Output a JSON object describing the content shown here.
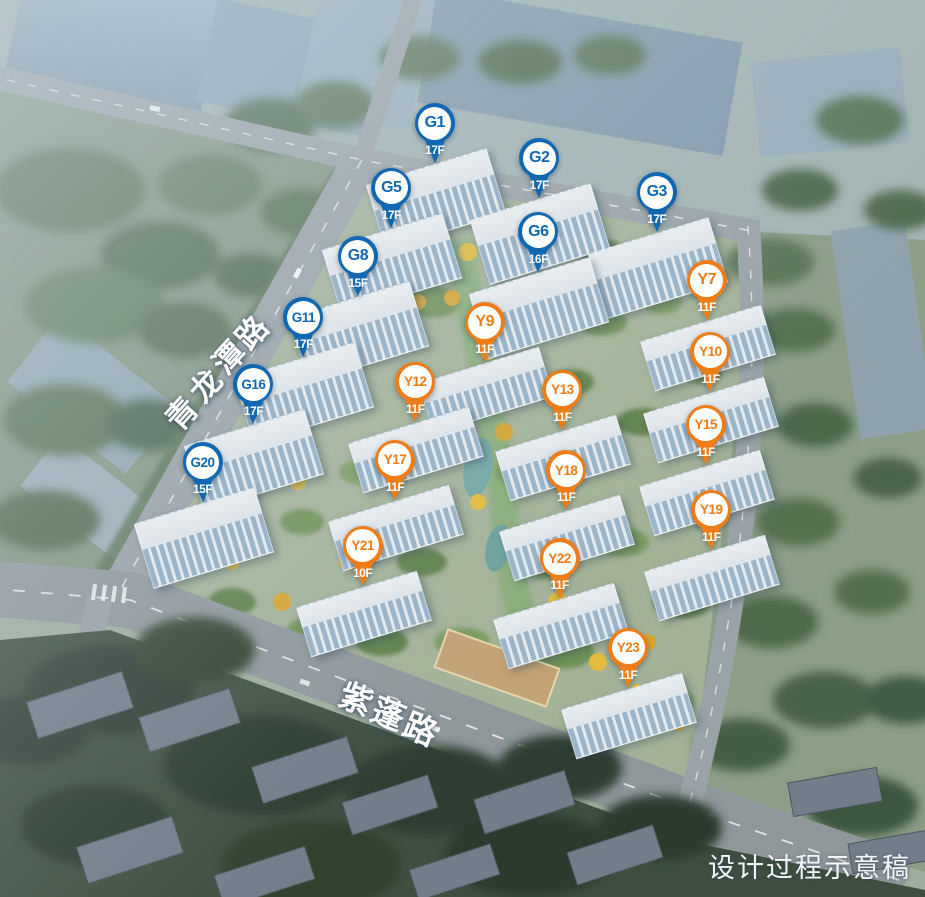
{
  "watermark": "设计过程示意稿",
  "roads": {
    "left_road": "青龙潭路",
    "bottom_road": "紫蓬路"
  },
  "pin_colors": {
    "G": "#1067b2",
    "Y": "#ee7d17"
  },
  "markers": [
    {
      "id": "G1",
      "floors": "17F",
      "type": "G",
      "x": 47.0,
      "y": 18.2
    },
    {
      "id": "G2",
      "floors": "17F",
      "type": "G",
      "x": 58.3,
      "y": 22.1
    },
    {
      "id": "G3",
      "floors": "17F",
      "type": "G",
      "x": 71.0,
      "y": 25.9
    },
    {
      "id": "G5",
      "floors": "17F",
      "type": "G",
      "x": 42.3,
      "y": 25.4
    },
    {
      "id": "G6",
      "floors": "16F",
      "type": "G",
      "x": 58.2,
      "y": 30.3
    },
    {
      "id": "G8",
      "floors": "15F",
      "type": "G",
      "x": 38.7,
      "y": 33.0
    },
    {
      "id": "G11",
      "floors": "17F",
      "type": "G",
      "x": 32.8,
      "y": 39.8
    },
    {
      "id": "G16",
      "floors": "17F",
      "type": "G",
      "x": 27.4,
      "y": 47.3
    },
    {
      "id": "G20",
      "floors": "15F",
      "type": "G",
      "x": 21.9,
      "y": 56.0
    },
    {
      "id": "Y7",
      "floors": "11F",
      "type": "Y",
      "x": 76.4,
      "y": 35.7
    },
    {
      "id": "Y9",
      "floors": "11F",
      "type": "Y",
      "x": 52.4,
      "y": 40.4
    },
    {
      "id": "Y10",
      "floors": "11F",
      "type": "Y",
      "x": 76.8,
      "y": 43.7
    },
    {
      "id": "Y12",
      "floors": "11F",
      "type": "Y",
      "x": 44.9,
      "y": 47.0
    },
    {
      "id": "Y13",
      "floors": "11F",
      "type": "Y",
      "x": 60.8,
      "y": 47.9
    },
    {
      "id": "Y15",
      "floors": "11F",
      "type": "Y",
      "x": 76.3,
      "y": 51.8
    },
    {
      "id": "Y17",
      "floors": "11F",
      "type": "Y",
      "x": 42.7,
      "y": 55.7
    },
    {
      "id": "Y18",
      "floors": "11F",
      "type": "Y",
      "x": 61.2,
      "y": 56.9
    },
    {
      "id": "Y19",
      "floors": "11F",
      "type": "Y",
      "x": 76.9,
      "y": 61.3
    },
    {
      "id": "Y21",
      "floors": "10F",
      "type": "Y",
      "x": 39.2,
      "y": 65.3
    },
    {
      "id": "Y22",
      "floors": "11F",
      "type": "Y",
      "x": 60.5,
      "y": 66.7
    },
    {
      "id": "Y23",
      "floors": "11F",
      "type": "Y",
      "x": 67.9,
      "y": 76.7
    }
  ]
}
